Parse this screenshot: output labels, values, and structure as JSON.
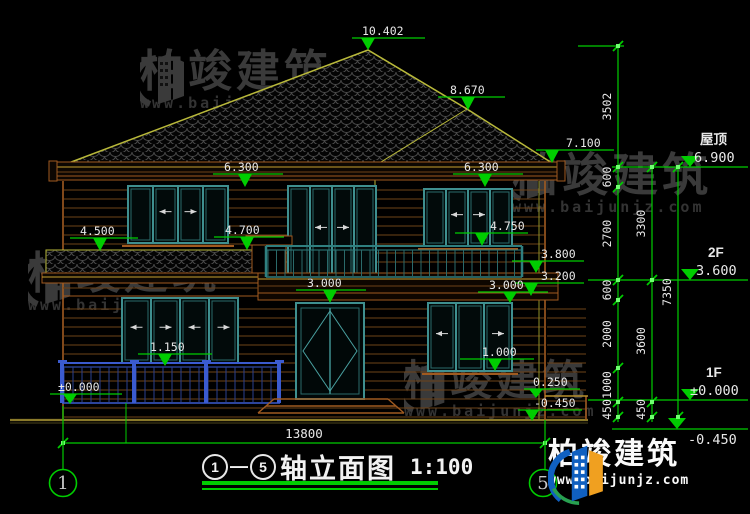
{
  "title": {
    "axis_start": "1",
    "axis_end": "5",
    "dash": "—",
    "name": "轴立面图",
    "scale": "1:100"
  },
  "axis_bubbles": {
    "left": "1",
    "right": "5"
  },
  "watermark": {
    "name": "柏竣建筑",
    "url": "www.baijunjz.com"
  },
  "logo": {
    "name": "柏竣建筑",
    "url": "www.baijunjz.com"
  },
  "bottom_dim": {
    "label": "13800",
    "x1": 63,
    "x2": 545,
    "y": 443,
    "tx": 304,
    "ty": 438
  },
  "levels": [
    {
      "name": "屋顶",
      "value": "6.900",
      "y": 167,
      "x1": 612,
      "x2": 748,
      "tri": 690,
      "nx": 700,
      "ny": 144,
      "vx": 694,
      "vy": 162,
      "below": false
    },
    {
      "name": "2F",
      "value": "3.600",
      "y": 280,
      "x1": 588,
      "x2": 748,
      "tri": 690,
      "nx": 708,
      "ny": 257,
      "vx": 696,
      "vy": 275,
      "below": false
    },
    {
      "name": "1F",
      "value": "±0.000",
      "y": 400,
      "x1": 588,
      "x2": 748,
      "tri": 690,
      "nx": 706,
      "ny": 377,
      "vx": 690,
      "vy": 395,
      "below": false
    },
    {
      "name": "",
      "value": "-0.450",
      "y": 429,
      "x1": 612,
      "x2": 748,
      "tri": 677,
      "nx": 0,
      "ny": 0,
      "vx": 688,
      "vy": 444,
      "below": true
    }
  ],
  "chains": [
    {
      "x": 618,
      "ticks": [
        46,
        167,
        187,
        280,
        300,
        368,
        402,
        417
      ],
      "labels": [
        "3502",
        "600",
        "2700",
        "600",
        "2000",
        "1000",
        "450"
      ]
    },
    {
      "x": 652,
      "ticks": [
        167,
        280,
        402,
        417
      ],
      "labels": [
        "3300",
        "3600",
        "450"
      ]
    },
    {
      "x": 678,
      "ticks": [
        167,
        417
      ],
      "labels": [
        "7350"
      ]
    }
  ],
  "elevation_markers": [
    {
      "label": "10.402",
      "lx1": 352,
      "lx2": 425,
      "ly": 38,
      "tx": 362,
      "ax": 368,
      "ay": 50
    },
    {
      "label": "8.670",
      "lx1": 438,
      "lx2": 505,
      "ly": 97,
      "tx": 450,
      "ax": 468,
      "ay": 110
    },
    {
      "label": "7.100",
      "lx1": 536,
      "lx2": 614,
      "ly": 150,
      "tx": 566,
      "ax": 552,
      "ay": 163
    },
    {
      "label": "6.300",
      "lx1": 213,
      "lx2": 283,
      "ly": 174,
      "tx": 224,
      "ax": 245,
      "ay": 187
    },
    {
      "label": "6.300",
      "lx1": 453,
      "lx2": 523,
      "ly": 174,
      "tx": 464,
      "ax": 485,
      "ay": 187
    },
    {
      "label": "4.500",
      "lx1": 70,
      "lx2": 138,
      "ly": 238,
      "tx": 80,
      "ax": 100,
      "ay": 251
    },
    {
      "label": "4.700",
      "lx1": 214,
      "lx2": 284,
      "ly": 237,
      "tx": 225,
      "ax": 247,
      "ay": 250
    },
    {
      "label": "4.750",
      "lx1": 455,
      "lx2": 528,
      "ly": 233,
      "tx": 490,
      "ax": 482,
      "ay": 246
    },
    {
      "label": "3.800",
      "lx1": 512,
      "lx2": 584,
      "ly": 261,
      "tx": 541,
      "ax": 536,
      "ay": 273
    },
    {
      "label": "3.200",
      "lx1": 515,
      "lx2": 584,
      "ly": 283,
      "tx": 541,
      "ax": 531,
      "ay": 296
    },
    {
      "label": "3.000",
      "lx1": 296,
      "lx2": 366,
      "ly": 290,
      "tx": 307,
      "ax": 330,
      "ay": 303
    },
    {
      "label": "3.000",
      "lx1": 478,
      "lx2": 548,
      "ly": 292,
      "tx": 489,
      "ax": 510,
      "ay": 303
    },
    {
      "label": "1.150",
      "lx1": 138,
      "lx2": 212,
      "ly": 354,
      "tx": 150,
      "ax": 165,
      "ay": 366
    },
    {
      "label": "1.000",
      "lx1": 460,
      "lx2": 534,
      "ly": 359,
      "tx": 482,
      "ax": 495,
      "ay": 371
    },
    {
      "label": "±0.000",
      "lx1": 50,
      "lx2": 122,
      "ly": 394,
      "tx": 58,
      "ax": 70,
      "ay": 404
    },
    {
      "label": "0.250",
      "lx1": 524,
      "lx2": 580,
      "ly": 389,
      "tx": 533,
      "ax": 536,
      "ay": 398
    },
    {
      "label": "-0.450",
      "lx1": 518,
      "lx2": 582,
      "ly": 410,
      "tx": 534,
      "ax": 532,
      "ay": 421
    }
  ]
}
